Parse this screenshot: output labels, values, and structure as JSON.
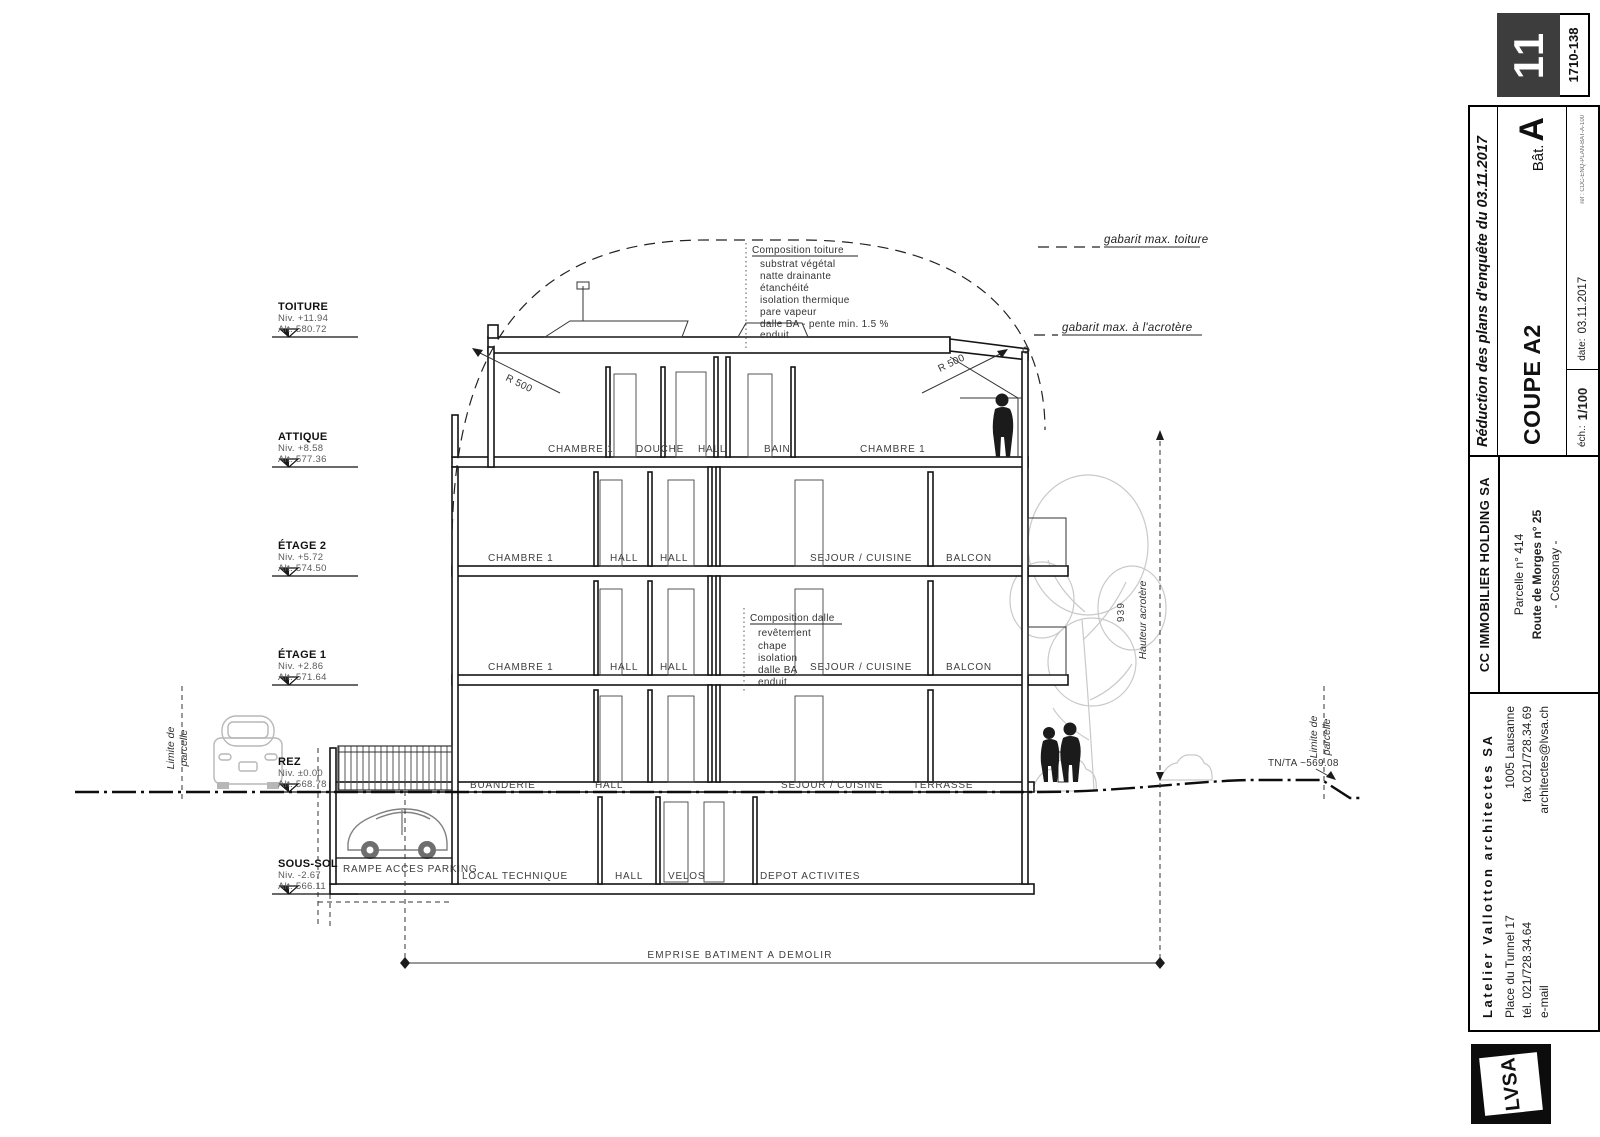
{
  "levels": [
    {
      "name": "TOITURE",
      "niv": "Niv. +11.94",
      "alt": "Alt. 580.72"
    },
    {
      "name": "ATTIQUE",
      "niv": "Niv. +8.58",
      "alt": "Alt. 577.36"
    },
    {
      "name": "ÉTAGE 2",
      "niv": "Niv. +5.72",
      "alt": "Alt. 574.50"
    },
    {
      "name": "ÉTAGE 1",
      "niv": "Niv. +2.86",
      "alt": "Alt. 571.64"
    },
    {
      "name": "REZ",
      "niv": "Niv. ±0.00",
      "alt": "Alt. 568.78"
    },
    {
      "name": "SOUS-SOL",
      "niv": "Niv. -2.67",
      "alt": "Alt. 566.11"
    }
  ],
  "rooms": {
    "attique": [
      "CHAMBRE 1",
      "DOUCHE",
      "HALL",
      "BAIN",
      "CHAMBRE 1"
    ],
    "etage2": [
      "CHAMBRE 1",
      "HALL",
      "HALL",
      "SEJOUR / CUISINE",
      "BALCON"
    ],
    "etage1": [
      "CHAMBRE 1",
      "HALL",
      "HALL",
      "SEJOUR / CUISINE",
      "BALCON"
    ],
    "rez": [
      "BUANDERIE",
      "HALL",
      "SEJOUR / CUISINE",
      "TERRASSE"
    ],
    "soussol": [
      "LOCAL TECHNIQUE",
      "HALL",
      "VELOS",
      "DEPOT ACTIVITES"
    ]
  },
  "annotations": {
    "gabarit_toiture": "gabarit max. toiture",
    "gabarit_acrotere": "gabarit max. à l'acrotère",
    "composition_toiture": {
      "title": "Composition toiture",
      "items": [
        "substrat végétal",
        "natte drainante",
        "étanchéité",
        "isolation thermique",
        "pare vapeur",
        "dalle BA - pente min. 1.5 %",
        "enduit"
      ]
    },
    "composition_dalle": {
      "title": "Composition dalle",
      "items": [
        "revêtement",
        "chape",
        "isolation",
        "dalle BA",
        "enduit"
      ]
    },
    "r500": "R 500",
    "hauteur_value": "939",
    "hauteur_label": "Hauteur acrotère",
    "tnta": "TN/TA ~569.08",
    "limite": {
      "line1": "Limite de",
      "line2": "parcelle"
    },
    "emprise": "EMPRISE BATIMENT A DEMOLIR",
    "rampe": "RAMPE ACCES PARKING"
  },
  "titleblock": {
    "page": "11",
    "project_no": "1710-138",
    "revision": "Réduction des plans d'enquête du 03.11.2017",
    "drawing": "COUPE A2",
    "bat_label": "Bât.",
    "bat": "A",
    "scale_label": "éch.:",
    "scale": "1/100",
    "date_label": "date:",
    "date": "03.11.2017",
    "ref": "ref : CDC-ENQ-PLAN-BAT-A-100",
    "client": {
      "name": "CC IMMOBILIER HOLDING SA",
      "line1": "Parcelle n° 414",
      "line2": "Route de Morges n° 25",
      "line3": "- Cossonay -"
    },
    "architect": {
      "name": "Latelier Vallotton architectes SA",
      "addr1": "Place du Tunnel 17",
      "addr2": "1005 Lausanne",
      "tel": "tél. 021/728.34.64",
      "fax": "fax 021/728.34.69",
      "email_label": "e-mail",
      "email": "architectes@lvsa.ch",
      "logo": "LVSA"
    }
  }
}
